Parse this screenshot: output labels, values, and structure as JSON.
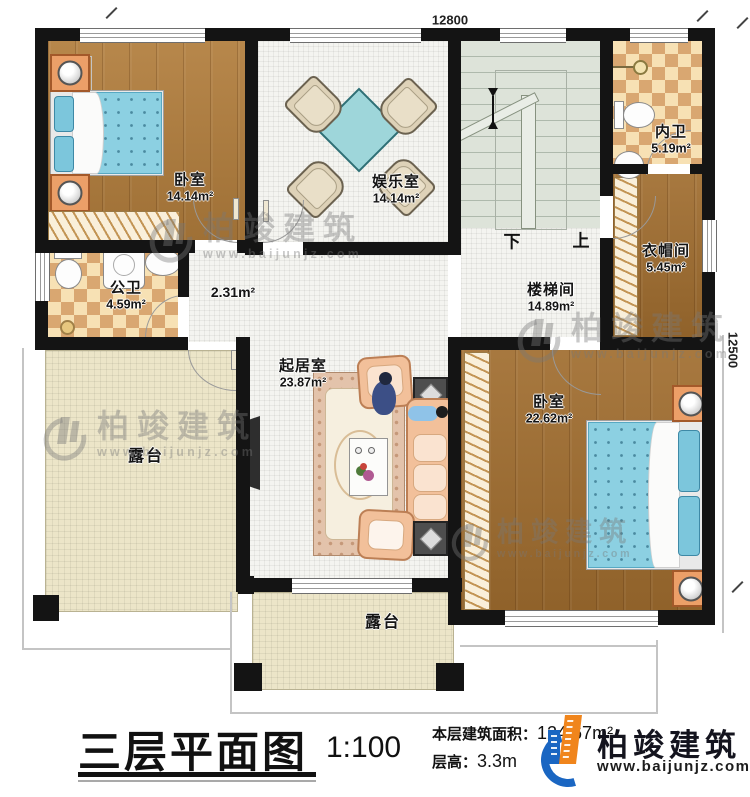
{
  "dimensions": {
    "top": "12800",
    "right": "12500"
  },
  "rooms": {
    "bedroom_tl": {
      "label": "卧室",
      "area": "14.14m²"
    },
    "entertainment": {
      "label": "娱乐室",
      "area": "14.14m²"
    },
    "neiwei": {
      "label": "内卫",
      "area": "5.19m²"
    },
    "cloakroom": {
      "label": "衣帽间",
      "area": "5.45m²"
    },
    "gongwei": {
      "label": "公卫",
      "area": "4.59m²"
    },
    "corridor": {
      "area": "2.31m²"
    },
    "stairhall": {
      "label": "楼梯间",
      "area": "14.89m²"
    },
    "living": {
      "label": "起居室",
      "area": "23.87m²"
    },
    "bedroom_r": {
      "label": "卧室",
      "area": "22.62m²"
    },
    "terrace_left": {
      "label": "露台"
    },
    "terrace_bottom": {
      "label": "露台"
    }
  },
  "stairs": {
    "down": "下",
    "up": "上"
  },
  "titleblock": {
    "title": "三层平面图",
    "scale": "1:100",
    "area_label": "本层建筑面积：",
    "area_value": "124.67m²",
    "height_label": "层高：",
    "height_value": "3.3m"
  },
  "branding": {
    "company": "柏竣建筑",
    "website": "www.baijunjz.com"
  },
  "colors": {
    "wall": "#141414",
    "wood": "#b17d3c",
    "tile": "#f4f4f0",
    "terrace": "#ece5c8",
    "stair": "#dde3d9",
    "checker_dark": "#d9a771",
    "checker_light": "#f7e1b4",
    "bed_blue": "#8cd0e2",
    "accent_blue": "#1a66c2",
    "accent_orange": "#f0851c"
  }
}
